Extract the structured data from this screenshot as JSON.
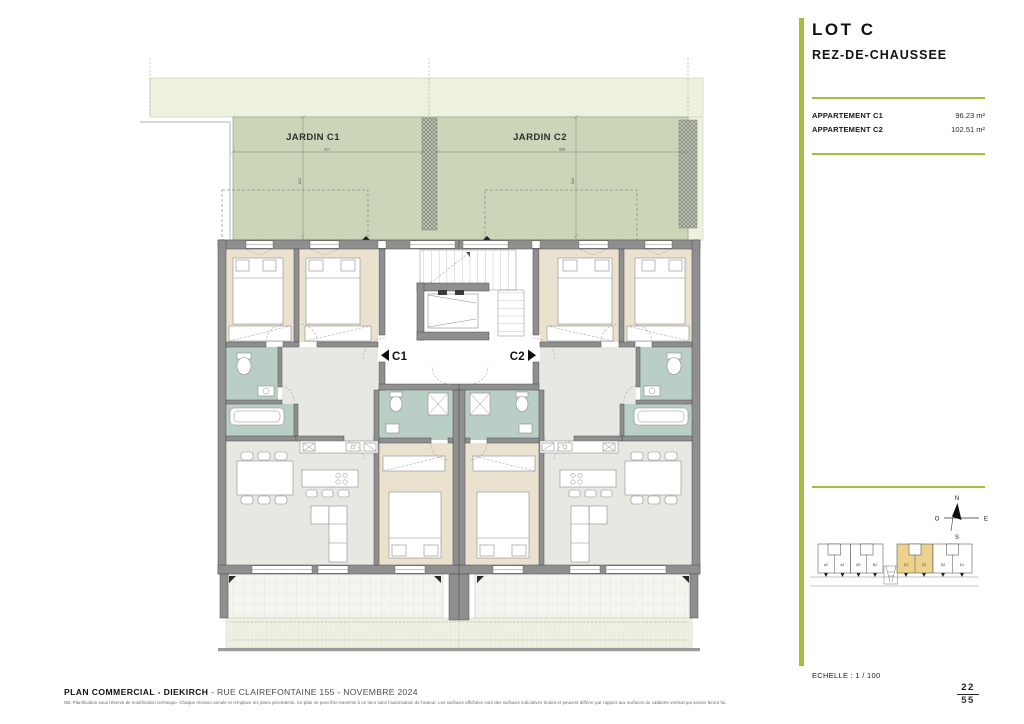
{
  "sidebar": {
    "lot_title": "LOT C",
    "floor_title": "REZ-DE-CHAUSSEE",
    "apartments": [
      {
        "label": "APPARTEMENT C1",
        "area": "96.23 m²"
      },
      {
        "label": "APPARTEMENT C2",
        "area": "102.51 m²"
      }
    ],
    "scale_label": "ECHELLE : 1 / 100",
    "page": {
      "current": "22",
      "total": "55"
    },
    "compass": {
      "n": "N",
      "e": "E",
      "s": "S",
      "w": "O"
    },
    "keyplan": {
      "units": [
        "A2",
        "A1",
        "B2",
        "B1",
        "C1",
        "C2",
        "D2",
        "D1"
      ],
      "highlighted_units": "C1, C2",
      "highlight_color": "#ecd28d"
    }
  },
  "plan": {
    "garden_c1": "JARDIN C1",
    "garden_c2": "JARDIN C2",
    "dim_c1_w": "917",
    "dim_c2_w": "955",
    "dim_c1_h": "610",
    "dim_c2_h": "610",
    "apt_c1": "C1",
    "apt_c2": "C2"
  },
  "footer": {
    "title_bold": "PLAN COMMERCIAL - DIEKIRCH",
    "title_rest": " - RUE CLAIREFONTAINE 155 - NOVEMBRE 2024",
    "disclaimer": "NB: Planification sous réserve de modification technique. Chaque révision annule et remplace les plans précédents. Ce plan ne peut être transmis à un tiers sans l'autorisation de l'auteur. Les surfaces affichées sont des surfaces indicatives brutes et peuvent différer par rapport aux surfaces du cadastre vertical qui seules feront foi."
  },
  "colors": {
    "accent_green": "#a3bf3b",
    "garden_green": "#cbd5b8",
    "garden_pale": "#edf2df",
    "room_beige": "#eae2cf",
    "room_wet_green": "#b9cec4",
    "room_gray": "#e8e8e3",
    "wall_gray": "#8f8f8f",
    "keyplan_highlight": "#ecd28d"
  }
}
